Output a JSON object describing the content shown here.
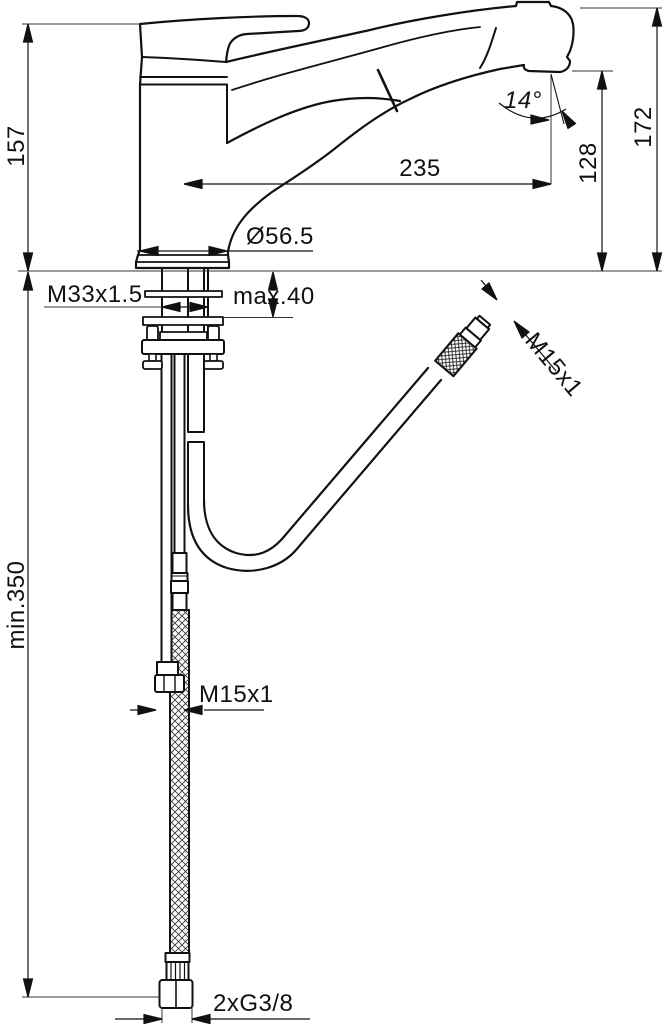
{
  "drawing": {
    "type": "technical-dimension-drawing",
    "subject": "single-lever kitchen mixer tap with pull-out spray head",
    "background": "#ffffff",
    "line_color": "#111111",
    "labels": {
      "height_total": "157",
      "height_to_spray_top": "172",
      "height_to_outlet": "128",
      "spout_reach": "235",
      "outlet_angle": "14°",
      "base_diameter": "Ø56.5",
      "body_thread": "M33x1.5",
      "deck_thickness": "max.40",
      "hose_thread_top": "M15x1",
      "hose_thread_mid": "M15x1",
      "min_clearance": "min.350",
      "supply_thread": "2xG3/8"
    }
  }
}
